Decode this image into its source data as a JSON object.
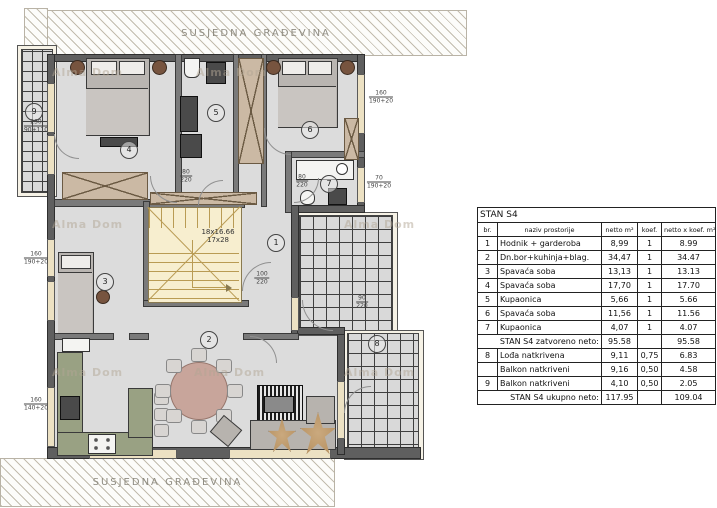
{
  "labels": {
    "neighbor_top": "SUSJEDNA GRAĐEVINA",
    "neighbor_bottom": "SUSJEDNA GRAĐEVINA",
    "watermark": "Alma Dom"
  },
  "plan": {
    "stairs_label_line1": "18x16.66",
    "stairs_label_line2": "17x28",
    "room_markers": [
      {
        "n": "1",
        "x": 275,
        "y": 242
      },
      {
        "n": "2",
        "x": 208,
        "y": 339
      },
      {
        "n": "3",
        "x": 104,
        "y": 281
      },
      {
        "n": "4",
        "x": 128,
        "y": 149
      },
      {
        "n": "5",
        "x": 215,
        "y": 112
      },
      {
        "n": "6",
        "x": 309,
        "y": 129
      },
      {
        "n": "7",
        "x": 328,
        "y": 183
      },
      {
        "n": "8",
        "x": 376,
        "y": 343
      },
      {
        "n": "9",
        "x": 33,
        "y": 111
      }
    ],
    "dimension_labels": [
      {
        "top": "160",
        "bottom": "190+20",
        "x": 381,
        "y": 97
      },
      {
        "top": "70",
        "bottom": "190+20",
        "x": 379,
        "y": 182
      },
      {
        "top": "160",
        "bottom": "190+20",
        "x": 36,
        "y": 258
      },
      {
        "top": "160",
        "bottom": "140+20",
        "x": 36,
        "y": 404
      },
      {
        "top": "230",
        "bottom": "90+110",
        "x": 36,
        "y": 126
      },
      {
        "top": "80",
        "bottom": "220",
        "x": 186,
        "y": 176
      },
      {
        "top": "80",
        "bottom": "220",
        "x": 302,
        "y": 181
      },
      {
        "top": "100",
        "bottom": "220",
        "x": 262,
        "y": 278
      },
      {
        "top": "90",
        "bottom": "220",
        "x": 362,
        "y": 302
      }
    ],
    "watermarks": [
      {
        "x": 52,
        "y": 66
      },
      {
        "x": 196,
        "y": 66
      },
      {
        "x": 52,
        "y": 218
      },
      {
        "x": 344,
        "y": 218
      },
      {
        "x": 52,
        "y": 366
      },
      {
        "x": 194,
        "y": 366
      },
      {
        "x": 344,
        "y": 366
      }
    ]
  },
  "table": {
    "title": "STAN S4",
    "headers": [
      "br.",
      "naziv prostorije",
      "netto m²",
      "koef.",
      "netto x koef. m²"
    ],
    "rows": [
      {
        "type": "data",
        "br": "1",
        "name": "Hodnik + garderoba",
        "netto": "8,99",
        "koef": "1",
        "result": "8.99"
      },
      {
        "type": "data",
        "br": "2",
        "name": "Dn.bor+kuhinja+blag.",
        "netto": "34,47",
        "koef": "1",
        "result": "34.47"
      },
      {
        "type": "data",
        "br": "3",
        "name": "Spavaća soba",
        "netto": "13,13",
        "koef": "1",
        "result": "13.13"
      },
      {
        "type": "data",
        "br": "4",
        "name": "Spavaća soba",
        "netto": "17,70",
        "koef": "1",
        "result": "17.70"
      },
      {
        "type": "data",
        "br": "5",
        "name": "Kupaonica",
        "netto": "5,66",
        "koef": "1",
        "result": "5.66"
      },
      {
        "type": "data",
        "br": "6",
        "name": "Spavaća soba",
        "netto": "11,56",
        "koef": "1",
        "result": "11.56"
      },
      {
        "type": "data",
        "br": "7",
        "name": "Kupaonica",
        "netto": "4,07",
        "koef": "1",
        "result": "4.07"
      },
      {
        "type": "summary",
        "br": "",
        "name": "STAN S4 zatvoreno neto:",
        "netto": "95.58",
        "koef": "",
        "result": "95.58"
      },
      {
        "type": "data",
        "br": "8",
        "name": "Lođa natkrivena",
        "netto": "9,11",
        "koef": "0,75",
        "result": "6.83"
      },
      {
        "type": "data",
        "br": "",
        "name": "Balkon natkriveni",
        "netto": "9,16",
        "koef": "0,50",
        "result": "4.58"
      },
      {
        "type": "data",
        "br": "9",
        "name": "Balkon natkriveni",
        "netto": "4,10",
        "koef": "0,50",
        "result": "2.05"
      },
      {
        "type": "summary",
        "br": "",
        "name": "STAN S4 ukupno neto:",
        "netto": "117.95",
        "koef": "",
        "result": "109.04"
      }
    ]
  },
  "colors": {
    "wall": "#5f5f5f",
    "floor": "#dcdcdc",
    "tiles": "#d9d9d9",
    "stairs": "#f7eecf",
    "kitchen": "#99a183",
    "dining_table": "#c8a59b",
    "window_frame": "#ece1c3",
    "wood": "#cbb9a4"
  }
}
